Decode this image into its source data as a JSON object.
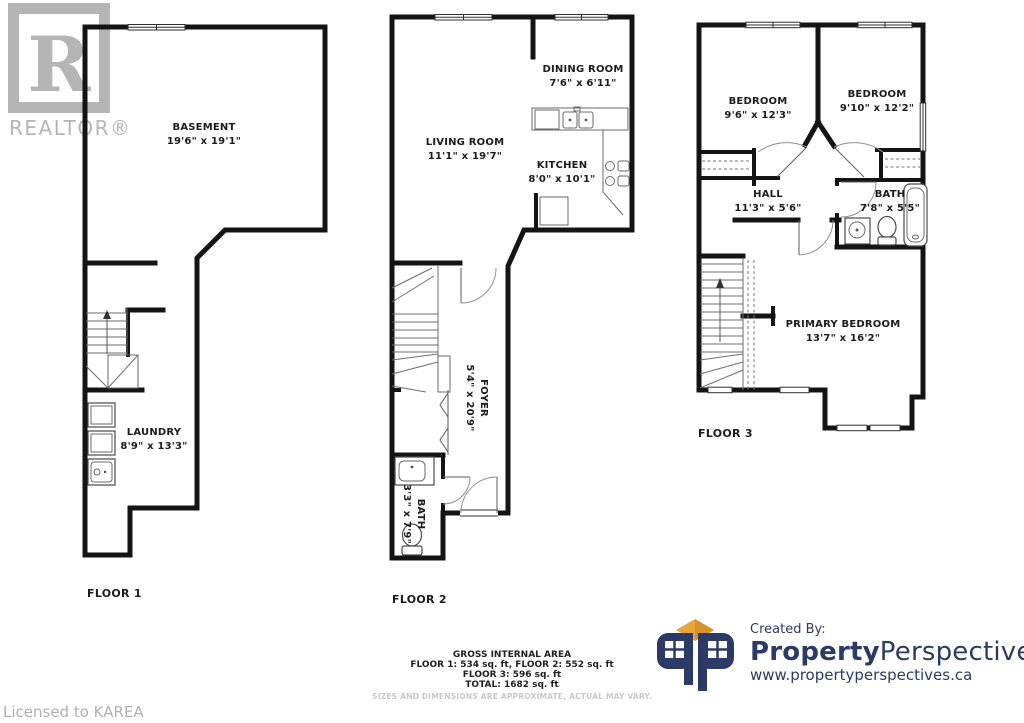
{
  "watermark": {
    "logo_letter": "R",
    "brand_text": "REALTOR®"
  },
  "license": {
    "text": "Licensed to KAREA"
  },
  "floors": [
    {
      "label": "FLOOR 1",
      "rooms": [
        {
          "name": "BASEMENT",
          "dims": "19'6\" x 19'1\""
        },
        {
          "name": "LAUNDRY",
          "dims": "8'9\" x 13'3\""
        }
      ]
    },
    {
      "label": "FLOOR 2",
      "rooms": [
        {
          "name": "LIVING ROOM",
          "dims": "11'1\" x 19'7\""
        },
        {
          "name": "DINING ROOM",
          "dims": "7'6\" x 6'11\""
        },
        {
          "name": "KITCHEN",
          "dims": "8'0\" x 10'1\""
        },
        {
          "name": "FOYER",
          "dims": "5'4\" x 20'9\""
        },
        {
          "name": "BATH",
          "dims": "3'3\" x 7'9\""
        }
      ]
    },
    {
      "label": "FLOOR 3",
      "rooms": [
        {
          "name": "BEDROOM",
          "dims": "9'6\" x 12'3\""
        },
        {
          "name": "BEDROOM",
          "dims": "9'10\" x 12'2\""
        },
        {
          "name": "HALL",
          "dims": "11'3\" x 5'6\""
        },
        {
          "name": "BATH",
          "dims": "7'8\" x 5'5\""
        },
        {
          "name": "PRIMARY BEDROOM",
          "dims": "13'7\" x 16'2\""
        }
      ]
    }
  ],
  "area_summary": {
    "title": "GROSS INTERNAL AREA",
    "line1": "FLOOR 1: 534 sq. ft, FLOOR 2: 552 sq. ft",
    "line2": "FLOOR 3: 596 sq. ft",
    "line3": "TOTAL: 1682 sq. ft",
    "disclaimer": "SIZES AND DIMENSIONS ARE APPROXIMATE, ACTUAL MAY VARY."
  },
  "branding": {
    "created_by": "Created By:",
    "name_bold": "Property",
    "name_regular": "Perspectives",
    "url": "www.propertyperspectives.ca"
  },
  "colors": {
    "wall": "#141414",
    "watermark_gray": "#b5b5b5",
    "brand_navy": "#2b3a66",
    "brand_gold": "#e7a63a",
    "muted_text": "#c8c8c8"
  }
}
